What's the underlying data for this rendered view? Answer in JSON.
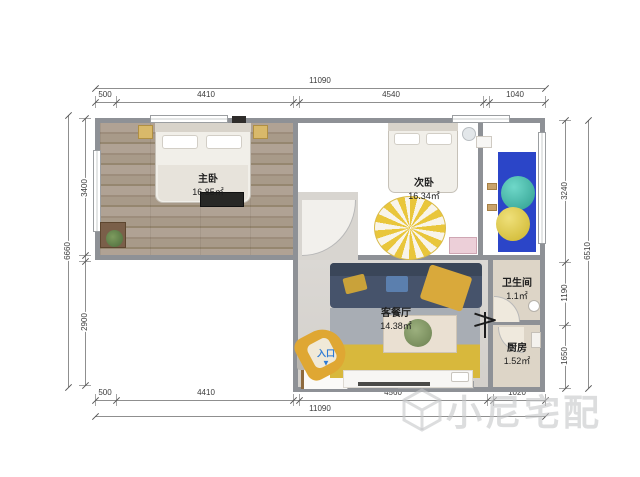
{
  "plan": {
    "rooms": [
      {
        "name": "主卧",
        "area": "16.85㎡"
      },
      {
        "name": "次卧",
        "area": "16.34㎡"
      },
      {
        "name": "客餐厅",
        "area": "14.38㎡"
      },
      {
        "name": "卫生间",
        "area": "1.1㎡"
      },
      {
        "name": "厨房",
        "area": "1.52㎡"
      }
    ],
    "entrance": {
      "label": "入口",
      "arrow": "▼"
    },
    "dimensions": {
      "top": {
        "overall": "11090",
        "segments": [
          "500",
          "4410",
          "4540",
          "1040"
        ]
      },
      "bottom": {
        "overall": "11090",
        "segments": [
          "500",
          "4410",
          "4560",
          "1020"
        ]
      },
      "left": {
        "overall": "6660",
        "segments": [
          "3400",
          "2900"
        ]
      },
      "right": {
        "overall": "6510",
        "segments": [
          "3240",
          "1190",
          "1650"
        ]
      }
    },
    "watermark": "小尼宅配",
    "colors": {
      "wall": "#8e9196",
      "entrance_blue": "#2e7bd6",
      "mat_blue": "#2b45c8",
      "ball_teal": "#45bfae",
      "ball_yellow": "#e3cd44",
      "sofa_navy": "#46536b",
      "rug_gray": "#a8adb4",
      "rug_yellow": "#d8b83c",
      "chair_yellow": "#dfa733"
    }
  }
}
